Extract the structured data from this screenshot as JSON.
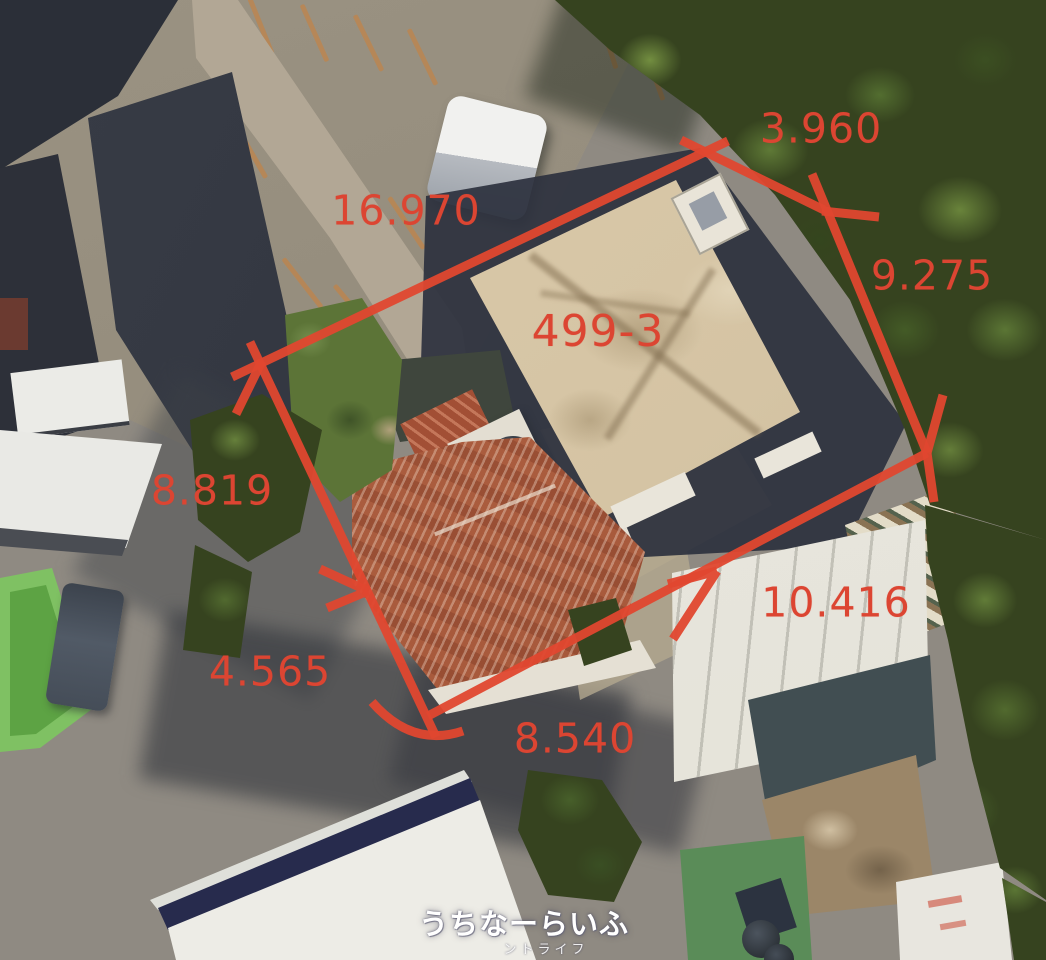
{
  "annotation": {
    "color_line": "#e0472f",
    "color_text": "#dc4532",
    "parcel_label": "499-3",
    "measurements": [
      {
        "edge": "top-left",
        "value": "16.970"
      },
      {
        "edge": "top",
        "value": "3.960"
      },
      {
        "edge": "right-upper",
        "value": "9.275"
      },
      {
        "edge": "right-lower",
        "value": "10.416"
      },
      {
        "edge": "bottom",
        "value": "8.540"
      },
      {
        "edge": "left-lower",
        "value": "4.565"
      },
      {
        "edge": "left-upper",
        "value": "8.819"
      }
    ]
  },
  "watermark": {
    "title": "うちなーらいふ",
    "subtitle": "ントライフ",
    "color": "#ffffff"
  }
}
